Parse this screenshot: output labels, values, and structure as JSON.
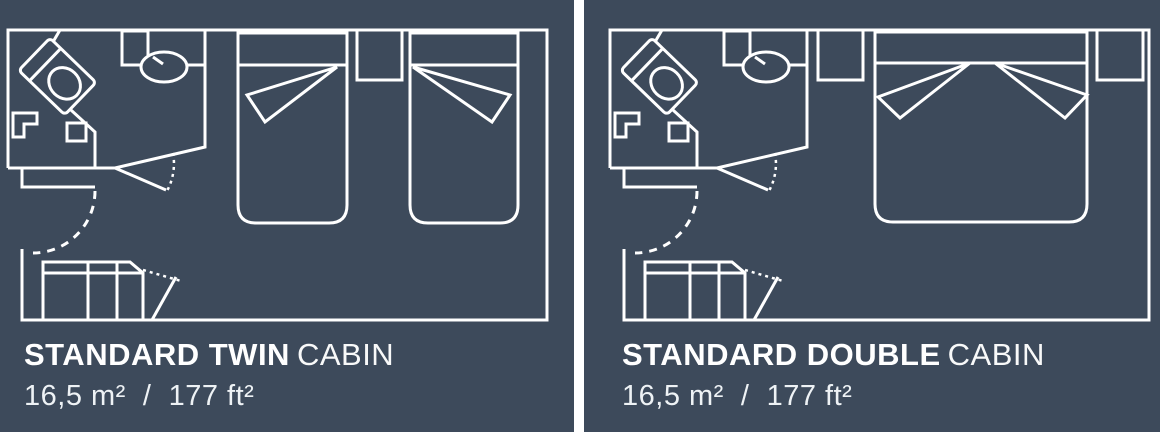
{
  "page": {
    "gutter_color": "#ffffff",
    "panel_background": "#3d4a5b",
    "line_color": "#ffffff"
  },
  "panels": [
    {
      "id": "standard-twin-cabin",
      "title_bold": "STANDARD TWIN",
      "title_regular": "CABIN",
      "area_label": "16,5 m²  /  177 ft²"
    },
    {
      "id": "standard-double-cabin",
      "title_bold": "STANDARD DOUBLE",
      "title_regular": "CABIN",
      "area_label": "16,5 m²  /  177 ft²"
    }
  ]
}
